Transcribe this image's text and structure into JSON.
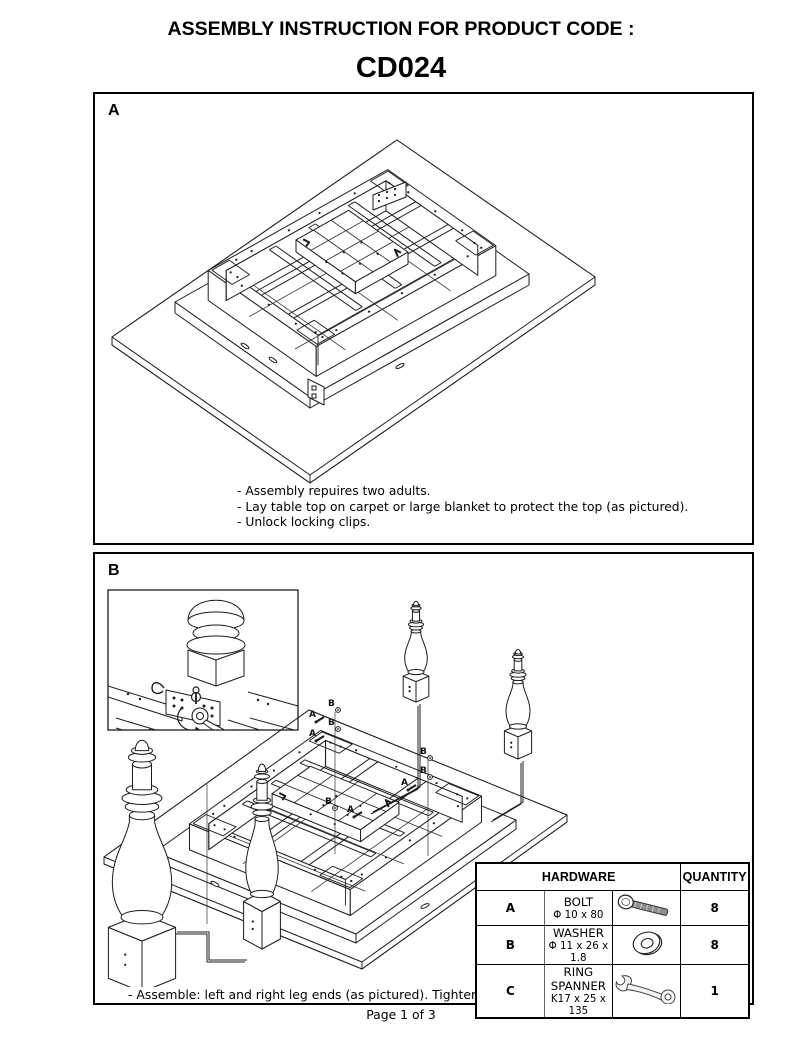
{
  "title": "ASSEMBLY INSTRUCTION FOR PRODUCT CODE :",
  "product_code": "CD024",
  "panel_a": {
    "label": "A",
    "notes": [
      "- Assembly repuires two adults.",
      "- Lay table top on carpet or large blanket to protect the top (as pictured).",
      "- Unlock locking clips."
    ]
  },
  "panel_b": {
    "label": "B",
    "note": "- Assemble: left and right leg ends (as pictured). Tighten all bolts (do not use power tools)."
  },
  "diagram_callouts": {
    "bolt_label": "A",
    "washer_label": "B"
  },
  "hardware_table": {
    "header_hardware": "HARDWARE",
    "header_quantity": "QUANTITY",
    "rows": [
      {
        "key": "A",
        "name": "BOLT",
        "spec": "Φ 10 x 80",
        "icon": "bolt-icon",
        "quantity": "8"
      },
      {
        "key": "B",
        "name": "WASHER",
        "spec": "Φ 11 x 26 x 1.8",
        "icon": "washer-icon",
        "quantity": "8"
      },
      {
        "key": "C",
        "name": "RING SPANNER",
        "spec": "K17 x 25 x 135",
        "icon": "ring-spanner-icon",
        "quantity": "1"
      }
    ]
  },
  "footer": {
    "page_label": "Page 1 of 3"
  }
}
